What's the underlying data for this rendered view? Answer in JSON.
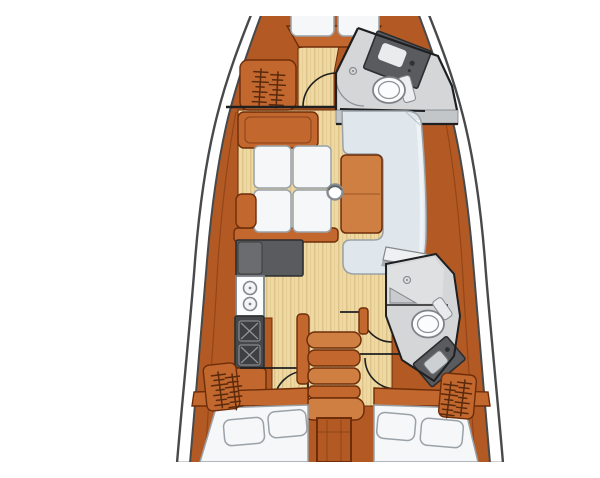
{
  "figure": {
    "kind": "sailboat-interior-layout-floorplan",
    "orientation": "bow-at-top, stern-at-bottom, top-down view",
    "regions": [
      {
        "id": "forward-cabin",
        "label": "forward V-berth cabin"
      },
      {
        "id": "forward-head",
        "label": "forward head with toilet, sink vanity and shower"
      },
      {
        "id": "salon",
        "label": "salon with port settee and starboard U-shaped dinette around table"
      },
      {
        "id": "galley",
        "label": "port galley with counter, double sink and two-burner stove"
      },
      {
        "id": "companionway",
        "label": "central companionway stairs and engine box"
      },
      {
        "id": "aft-head",
        "label": "starboard aft head with shower, toilet and sink vanity"
      },
      {
        "id": "port-aft-cabin",
        "label": "port aft double berth cabin with hanging locker"
      },
      {
        "id": "starboard-aft-cabin",
        "label": "starboard aft double berth cabin with hanging locker"
      }
    ],
    "elements": [
      "v-berth-cushions",
      "hanging-locker-symbols",
      "cabin-door-arcs",
      "mast-post",
      "saloon-table",
      "double-sink",
      "stove-burners",
      "toilets",
      "shower-drains",
      "companionway-steps",
      "aft-berth-pillows"
    ]
  },
  "colors": {
    "background": "#ffffff",
    "deck": "#ffffff",
    "line": "#47494b",
    "wall": "#1e1f20",
    "wood": "#b35a24",
    "wood-mid": "#c2672e",
    "wood-light": "#d07f42",
    "wood-line": "#6e2d09",
    "floor": "#eed9a4",
    "floor-stripe": "#ddc386",
    "cushion": "#f5f7f8",
    "cushion-line": "#9aa2a8",
    "settee": "#dfe7ed",
    "settee-hi": "#f0f4f7",
    "counter": "#595b5e",
    "counter-dark": "#46484b",
    "counter-line": "#2c2d2f",
    "burner": "#3d3f42",
    "burner-line": "#96999c",
    "fixture": "#fbfcfd",
    "fixture-line": "#7e8387",
    "head-floor": "#d4d6d8",
    "head-floor-hi": "#dee0e2",
    "head-line": "#8f9295",
    "symbol": "#5a2a0c"
  }
}
